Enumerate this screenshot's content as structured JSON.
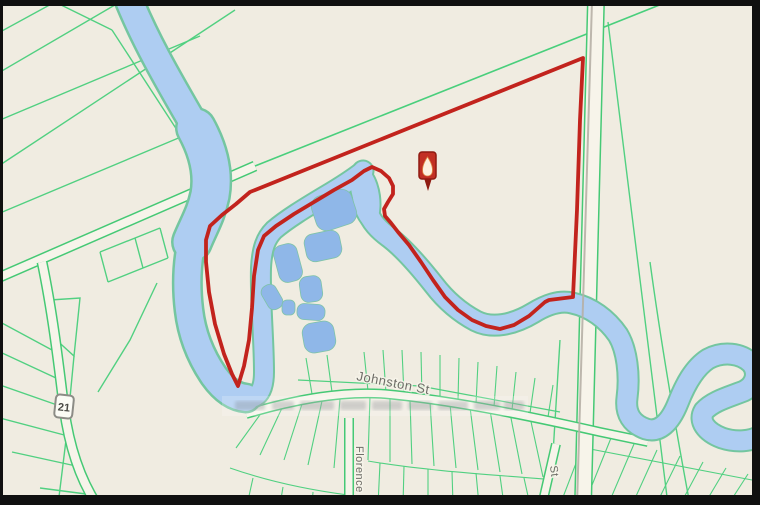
{
  "map": {
    "type": "property-parcel-map",
    "labels": {
      "johnston_st": "Johnston St",
      "florence_st": "Florence",
      "partial_st": "St",
      "highway_shield": "21"
    },
    "marker": {
      "name": "property-location-pin"
    },
    "colors": {
      "land": "#f0ece1",
      "parcel_line": "#49cf7c",
      "road_casing": "#45c975",
      "road_fill": "#f7f4ea",
      "water_fill": "#aecdf2",
      "water_edge": "#74c6a0",
      "pond_fill": "#8fb7e8",
      "pond_edge": "#7fc3a8",
      "boundary": "#c2231d",
      "frame": "#101010",
      "rail": "#b6b0a6",
      "label": "#6e6d67",
      "shield_fill": "#fbfbf5",
      "shield_border": "#8c8c86",
      "shield_text": "#4c4c47",
      "pin_red": "#c23024",
      "pin_border": "#8f1b12",
      "pin_flame": "#fdf1df",
      "pin_flame_edge": "#de8a45"
    }
  }
}
